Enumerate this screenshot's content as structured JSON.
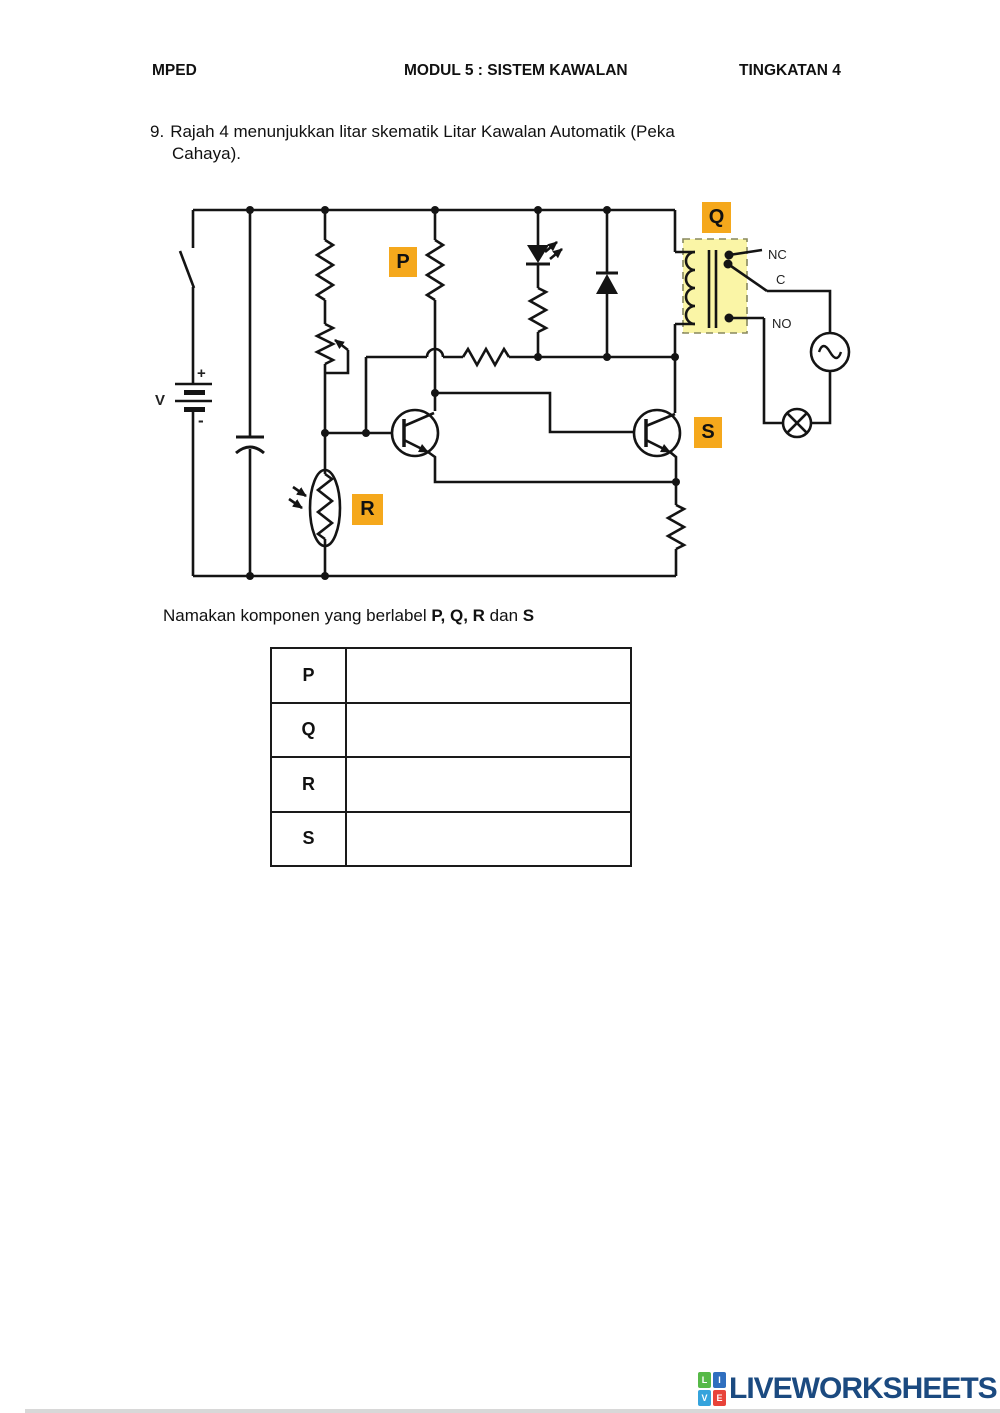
{
  "header": {
    "left": "MPED",
    "center": "MODUL 5 : SISTEM KAWALAN",
    "right": "TINGKATAN 4"
  },
  "question": {
    "number": "9.",
    "line1": "Rajah 4 menunjukkan litar skematik Litar Kawalan Automatik (Peka",
    "line2": "Cahaya)."
  },
  "instruction": {
    "text1": "Namakan komponen yang berlabel ",
    "bold1": "P, Q, R",
    "text2": " dan ",
    "bold2": "S"
  },
  "diagram": {
    "component_labels": {
      "p": "P",
      "q": "Q",
      "r": "R",
      "s": "S"
    },
    "battery": {
      "name": "V",
      "plus": "+",
      "minus": "-"
    },
    "relay_contacts": {
      "nc": "NC",
      "c": "C",
      "no": "NO"
    },
    "colors": {
      "label_highlight": "#F5A81C",
      "relay_fill": "#FAF5A6",
      "line": "#141414"
    }
  },
  "table": {
    "rows": [
      {
        "label": "P",
        "answer": ""
      },
      {
        "label": "Q",
        "answer": ""
      },
      {
        "label": "R",
        "answer": ""
      },
      {
        "label": "S",
        "answer": ""
      }
    ]
  },
  "footer": {
    "brand": "LIVEWORKSHEETS",
    "brand_color": "#1B4A80",
    "squares": [
      {
        "letter": "L",
        "color": "#56B947"
      },
      {
        "letter": "I",
        "color": "#2F6FBF"
      },
      {
        "letter": "V",
        "color": "#35A3DC"
      },
      {
        "letter": "E",
        "color": "#E8433A"
      }
    ]
  }
}
